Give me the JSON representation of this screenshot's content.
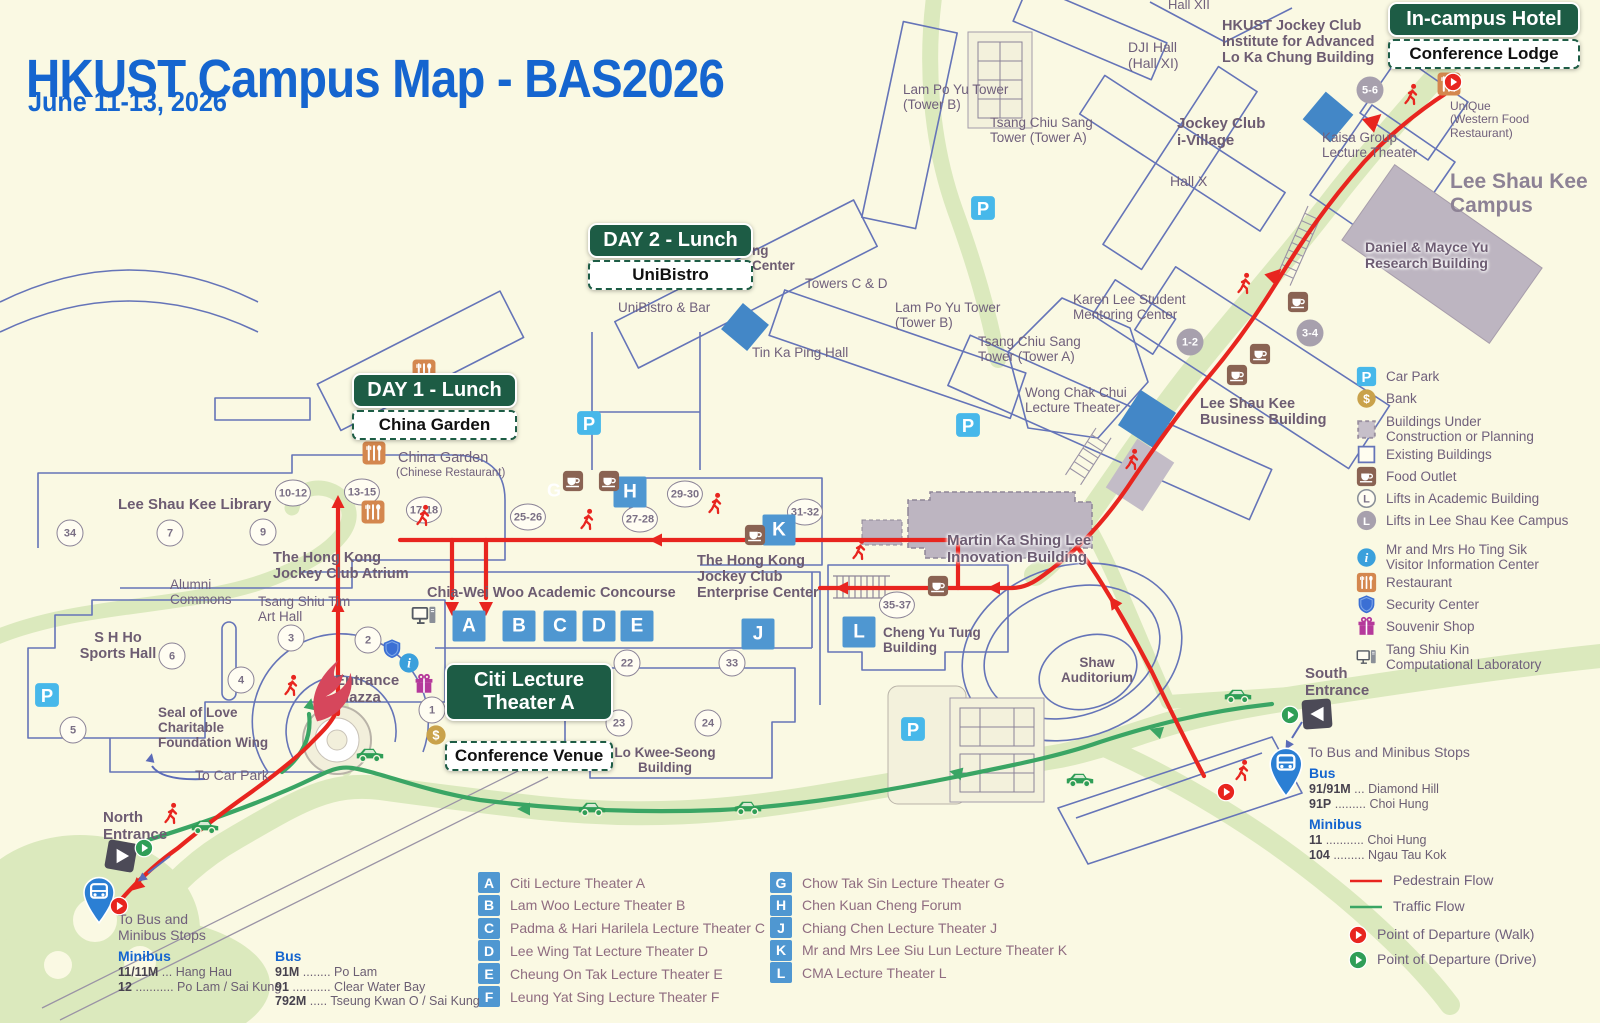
{
  "header": {
    "title": "HKUST Campus Map - BAS2026",
    "subtitle": "June 11-13, 2026"
  },
  "badges": {
    "day1": {
      "title": "DAY 1 - Lunch",
      "subtitle": "China Garden"
    },
    "day2": {
      "title": "DAY 2 - Lunch",
      "subtitle": "UniBistro"
    },
    "venue": {
      "title": "Citi Lecture\nTheater A",
      "subtitle": "Conference Venue"
    },
    "hotel": {
      "title": "In-campus Hotel",
      "subtitle": "Conference Lodge"
    }
  },
  "map_labels": [
    {
      "t": "Hall XII",
      "x": 1168,
      "y": -2,
      "s": 13
    },
    {
      "t": "HKUST Jockey Club\nInstitute for Advanced\nLo Ka Chung Building",
      "x": 1222,
      "y": 18,
      "b": 1,
      "s": 14.5
    },
    {
      "t": "DJI Hall\n(Hall XI)",
      "x": 1128,
      "y": 40,
      "s": 14
    },
    {
      "t": "Lam Po Yu Tower\n(Tower B)",
      "x": 903,
      "y": 82
    },
    {
      "t": "Tsang Chiu Sang\nTower (Tower A)",
      "x": 990,
      "y": 115
    },
    {
      "t": "Jockey Club\ni-Village",
      "x": 1177,
      "y": 116,
      "b": 1,
      "s": 15
    },
    {
      "t": "Hall X",
      "x": 1170,
      "y": 174,
      "s": 14
    },
    {
      "t": "Kaisa Group\nLecture Theater",
      "x": 1322,
      "y": 130
    },
    {
      "t": "UniQue\n(Western Food\nRestaurant)",
      "x": 1450,
      "y": 100,
      "s": 12
    },
    {
      "t": "Lee Shau Kee\nCampus",
      "x": 1450,
      "y": 170,
      "b": 1,
      "s": 21,
      "c": "#8d8295"
    },
    {
      "t": "Daniel & Mayce Yu\nResearch Building",
      "x": 1365,
      "y": 240,
      "b": 1,
      "s": 14,
      "halo": 1
    },
    {
      "t": "Karen Lee Student\nMentoring Center",
      "x": 1073,
      "y": 292
    },
    {
      "t": "ng\nCenter",
      "x": 752,
      "y": 243,
      "b": 1
    },
    {
      "t": "Towers C & D",
      "x": 805,
      "y": 276
    },
    {
      "t": "Lam Po Yu Tower\n(Tower B)",
      "x": 895,
      "y": 300
    },
    {
      "t": "Tsang Chiu Sang\nTower (Tower A)",
      "x": 978,
      "y": 334
    },
    {
      "t": "UniBistro & Bar",
      "x": 618,
      "y": 300
    },
    {
      "t": "Tin Ka Ping Hall",
      "x": 752,
      "y": 345
    },
    {
      "t": "Wong Chak Chui\nLecture Theater",
      "x": 1025,
      "y": 385
    },
    {
      "t": "Lee Shau Kee\nBusiness Building",
      "x": 1200,
      "y": 396,
      "b": 1,
      "s": 14.5
    },
    {
      "t": "China Garden",
      "x": 398,
      "y": 450,
      "s": 14.5
    },
    {
      "t": "(Chinese Restaurant)",
      "x": 396,
      "y": 467,
      "s": 11.5
    },
    {
      "t": "Lee Shau Kee Library",
      "x": 118,
      "y": 497,
      "b": 1,
      "s": 15
    },
    {
      "t": "The Hong Kong\nJockey Club Atrium",
      "x": 273,
      "y": 550,
      "b": 1,
      "s": 14.5
    },
    {
      "t": "Alumni\nCommons",
      "x": 170,
      "y": 577
    },
    {
      "t": "Tsang Shiu Tim\nArt Hall",
      "x": 258,
      "y": 594
    },
    {
      "t": "Chia-Wei Woo Academic Concourse",
      "x": 427,
      "y": 585,
      "b": 1,
      "s": 14.5
    },
    {
      "t": "The Hong Kong\nJockey Club\nEnterprise Center",
      "x": 697,
      "y": 553,
      "b": 1,
      "s": 14.5
    },
    {
      "t": "Martin Ka Shing Lee\nInnovation Building",
      "x": 947,
      "y": 533,
      "b": 1,
      "s": 15,
      "halo": 1
    },
    {
      "t": "S H Ho\nSports Hall",
      "x": 118,
      "y": 630,
      "b": 1,
      "s": 14.5,
      "a": "c"
    },
    {
      "t": "Cheng Yu Tung\nBuilding",
      "x": 883,
      "y": 625,
      "b": 1
    },
    {
      "t": "Shaw\nAuditorium",
      "x": 1097,
      "y": 655,
      "b": 1,
      "a": "c"
    },
    {
      "t": "Seal of Love\nCharitable\nFoundation Wing",
      "x": 158,
      "y": 705,
      "b": 1
    },
    {
      "t": "Entrance\nPiazza",
      "x": 335,
      "y": 673,
      "b": 1,
      "s": 15
    },
    {
      "t": "Lo Kwee-Seong\nBuilding",
      "x": 665,
      "y": 745,
      "b": 1,
      "a": "c"
    },
    {
      "t": "South\nEntrance",
      "x": 1305,
      "y": 666,
      "b": 1,
      "s": 15
    },
    {
      "t": "To Car Park",
      "x": 195,
      "y": 768,
      "s": 14
    },
    {
      "t": "North\nEntrance",
      "x": 103,
      "y": 810,
      "b": 1,
      "s": 15
    },
    {
      "t": "To Bus and\nMinibus Stops",
      "x": 118,
      "y": 912,
      "s": 14
    },
    {
      "t": "To Bus and Minibus Stops",
      "x": 1308,
      "y": 745,
      "s": 14
    }
  ],
  "lifts": [
    {
      "n": "34",
      "x": 70,
      "y": 533
    },
    {
      "n": "7",
      "x": 170,
      "y": 533
    },
    {
      "n": "9",
      "x": 263,
      "y": 532
    },
    {
      "n": "10-12",
      "x": 293,
      "y": 493
    },
    {
      "n": "13-15",
      "x": 362,
      "y": 492
    },
    {
      "n": "17-18",
      "x": 424,
      "y": 510
    },
    {
      "n": "25-26",
      "x": 528,
      "y": 517
    },
    {
      "n": "27-28",
      "x": 640,
      "y": 519
    },
    {
      "n": "29-30",
      "x": 685,
      "y": 494
    },
    {
      "n": "31-32",
      "x": 805,
      "y": 512
    },
    {
      "n": "3",
      "x": 291,
      "y": 638
    },
    {
      "n": "2",
      "x": 368,
      "y": 640
    },
    {
      "n": "6",
      "x": 172,
      "y": 656
    },
    {
      "n": "4",
      "x": 241,
      "y": 680
    },
    {
      "n": "1",
      "x": 432,
      "y": 710
    },
    {
      "n": "5",
      "x": 73,
      "y": 730
    },
    {
      "n": "22",
      "x": 627,
      "y": 663
    },
    {
      "n": "33",
      "x": 732,
      "y": 663
    },
    {
      "n": "23",
      "x": 619,
      "y": 723
    },
    {
      "n": "24",
      "x": 708,
      "y": 723
    },
    {
      "n": "35-37",
      "x": 897,
      "y": 605
    },
    {
      "n": "1-2",
      "x": 1190,
      "y": 342,
      "g": 1
    },
    {
      "n": "3-4",
      "x": 1310,
      "y": 333,
      "g": 1
    },
    {
      "n": "5-6",
      "x": 1370,
      "y": 90,
      "g": 1
    }
  ],
  "theater_squares": [
    {
      "k": "A",
      "x": 469,
      "y": 626
    },
    {
      "k": "B",
      "x": 519,
      "y": 626
    },
    {
      "k": "C",
      "x": 560,
      "y": 626
    },
    {
      "k": "D",
      "x": 599,
      "y": 626
    },
    {
      "k": "E",
      "x": 637,
      "y": 626
    },
    {
      "k": "J",
      "x": 758,
      "y": 634
    },
    {
      "k": "K",
      "x": 779,
      "y": 530
    },
    {
      "k": "H",
      "x": 630,
      "y": 492
    },
    {
      "k": "L",
      "x": 859,
      "y": 632
    },
    {
      "k": "G",
      "x": 554,
      "y": 491,
      "w": 1
    }
  ],
  "map_icons": [
    {
      "t": "car-park",
      "x": 983,
      "y": 208,
      "s": 26
    },
    {
      "t": "car-park",
      "x": 589,
      "y": 423,
      "s": 26
    },
    {
      "t": "car-park",
      "x": 968,
      "y": 425,
      "s": 26
    },
    {
      "t": "car-park",
      "x": 47,
      "y": 695,
      "s": 26
    },
    {
      "t": "car-park",
      "x": 913,
      "y": 729,
      "s": 26
    },
    {
      "t": "food-outlet",
      "x": 573,
      "y": 481
    },
    {
      "t": "food-outlet",
      "x": 609,
      "y": 481
    },
    {
      "t": "food-outlet",
      "x": 755,
      "y": 535
    },
    {
      "t": "food-outlet",
      "x": 938,
      "y": 586
    },
    {
      "t": "food-outlet",
      "x": 1237,
      "y": 375
    },
    {
      "t": "food-outlet",
      "x": 1298,
      "y": 302
    },
    {
      "t": "food-outlet",
      "x": 1260,
      "y": 354
    },
    {
      "t": "restaurant",
      "x": 374,
      "y": 453,
      "s": 25
    },
    {
      "t": "restaurant",
      "x": 373,
      "y": 512,
      "s": 25
    },
    {
      "t": "restaurant",
      "x": 424,
      "y": 371,
      "s": 25
    },
    {
      "t": "restaurant",
      "x": 1449,
      "y": 84,
      "s": 25
    },
    {
      "t": "visitor-info",
      "x": 409,
      "y": 663
    },
    {
      "t": "security",
      "x": 392,
      "y": 649
    },
    {
      "t": "souvenir",
      "x": 424,
      "y": 684
    },
    {
      "t": "bank",
      "x": 436,
      "y": 735
    },
    {
      "t": "computer",
      "x": 424,
      "y": 616,
      "s": 26
    },
    {
      "t": "bus-pin",
      "x": 99,
      "y": 900,
      "s": 38
    },
    {
      "t": "bus-pin",
      "x": 1286,
      "y": 772,
      "s": 40
    },
    {
      "t": "entrance-n",
      "x": 121,
      "y": 856,
      "s": 38
    },
    {
      "t": "entrance-s",
      "x": 1317,
      "y": 714,
      "s": 38
    },
    {
      "t": "dep-walk",
      "x": 119,
      "y": 906,
      "s": 20
    },
    {
      "t": "dep-walk",
      "x": 1453,
      "y": 82,
      "s": 20
    },
    {
      "t": "dep-walk",
      "x": 1226,
      "y": 792,
      "s": 20
    },
    {
      "t": "dep-drive",
      "x": 144,
      "y": 848,
      "s": 20
    },
    {
      "t": "dep-drive",
      "x": 1290,
      "y": 715,
      "s": 20
    },
    {
      "t": "flame",
      "x": 330,
      "y": 690,
      "s": 48
    },
    {
      "t": "walker",
      "x": 424,
      "y": 516,
      "s": 24
    },
    {
      "t": "walker",
      "x": 588,
      "y": 520,
      "s": 24
    },
    {
      "t": "walker",
      "x": 716,
      "y": 504,
      "s": 24
    },
    {
      "t": "walker",
      "x": 860,
      "y": 550,
      "s": 24
    },
    {
      "t": "walker",
      "x": 1133,
      "y": 460,
      "s": 24
    },
    {
      "t": "walker",
      "x": 1245,
      "y": 284,
      "s": 24
    },
    {
      "t": "walker",
      "x": 1412,
      "y": 95,
      "s": 24
    },
    {
      "t": "walker",
      "x": 1243,
      "y": 771,
      "s": 24
    },
    {
      "t": "walker",
      "x": 172,
      "y": 814,
      "s": 24
    },
    {
      "t": "walker",
      "x": 292,
      "y": 686,
      "s": 24
    },
    {
      "t": "car",
      "x": 205,
      "y": 824,
      "s": 30
    },
    {
      "t": "car",
      "x": 370,
      "y": 752,
      "s": 30
    },
    {
      "t": "car",
      "x": 592,
      "y": 806,
      "s": 30
    },
    {
      "t": "car",
      "x": 748,
      "y": 805,
      "s": 30
    },
    {
      "t": "car",
      "x": 1080,
      "y": 777,
      "s": 30
    },
    {
      "t": "car",
      "x": 1238,
      "y": 693,
      "s": 30
    },
    {
      "t": "tennis-court",
      "x": 1000,
      "y": 80,
      "s": 0
    },
    {
      "t": "tennis-court",
      "x": 997,
      "y": 750,
      "s": 0
    }
  ],
  "legend": {
    "x_icon": 1356,
    "x_label": 1390,
    "items": [
      {
        "icon": "car-park",
        "label": "Car Park",
        "y": 377
      },
      {
        "icon": "bank",
        "label": "Bank",
        "y": 399
      },
      {
        "icon": "construction",
        "label": "Buildings Under\nConstruction or Planning",
        "y": 425
      },
      {
        "icon": "existing",
        "label": "Existing Buildings",
        "y": 455
      },
      {
        "icon": "food-outlet",
        "label": "Food Outlet",
        "y": 477
      },
      {
        "icon": "lift-academic",
        "label": "Lifts in Academic Building",
        "y": 499
      },
      {
        "icon": "lift-lsk",
        "label": "Lifts in Lee Shau Kee Campus",
        "y": 521
      },
      {
        "icon": "visitor-info",
        "label": "Mr and Mrs Ho Ting Sik\nVisitor Information Center",
        "y": 553
      },
      {
        "icon": "restaurant",
        "label": "Restaurant",
        "y": 583
      },
      {
        "icon": "security",
        "label": "Security Center",
        "y": 605
      },
      {
        "icon": "souvenir",
        "label": "Souvenir Shop",
        "y": 627
      },
      {
        "icon": "computer",
        "label": "Tang Shiu Kin\nComputational Laboratory",
        "y": 653
      }
    ]
  },
  "flow_legend": {
    "x_icon": 1348,
    "x_label": 1393,
    "items": [
      {
        "icon": "ped-flow",
        "label": "Pedestrain Flow",
        "y": 884
      },
      {
        "icon": "traffic-flow",
        "label": "Traffic Flow",
        "y": 910
      },
      {
        "icon": "dep-walk",
        "label": "Point of Departure (Walk)",
        "y": 936
      },
      {
        "icon": "dep-drive",
        "label": "Point of Departure (Drive)",
        "y": 961
      }
    ]
  },
  "theater_legend": {
    "left": {
      "sq_x": 478,
      "label_x": 505,
      "start_y": 882,
      "step": 22.8,
      "items": [
        {
          "k": "A",
          "label": "Citi Lecture Theater A"
        },
        {
          "k": "B",
          "label": "Lam Woo Lecture Theater B"
        },
        {
          "k": "C",
          "label": "Padma & Hari Harilela Lecture Theater C"
        },
        {
          "k": "D",
          "label": "Lee Wing Tat Lecture Theater D"
        },
        {
          "k": "E",
          "label": "Cheung On Tak Lecture Theater E"
        },
        {
          "k": "F",
          "label": "Leung Yat Sing Lecture Theater F"
        }
      ]
    },
    "right": {
      "sq_x": 770,
      "label_x": 797,
      "start_y": 882,
      "step": 22.6,
      "items": [
        {
          "k": "G",
          "label": "Chow Tak Sin Lecture Theater G"
        },
        {
          "k": "H",
          "label": "Chen Kuan Cheng Forum"
        },
        {
          "k": "J",
          "label": "Chiang Chen Lecture Theater J"
        },
        {
          "k": "K",
          "label": "Mr and Mrs Lee Siu Lun Lecture Theater K"
        },
        {
          "k": "L",
          "label": "CMA Lecture Theater L"
        }
      ]
    }
  },
  "bus_north": {
    "groups": [
      {
        "heading": "Minibus",
        "x": 118,
        "y": 948,
        "rows": [
          {
            "n": "11/11M",
            "r": " ... Hang Hau"
          },
          {
            "n": "12",
            "r": " ........... Po Lam / Sai Kung"
          }
        ]
      },
      {
        "heading": "Bus",
        "x": 275,
        "y": 948,
        "rows": [
          {
            "n": "91M",
            "r": " ........ Po Lam"
          },
          {
            "n": "91",
            "r": " ........... Clear Water Bay"
          },
          {
            "n": "792M",
            "r": " ..... Tseung Kwan O / Sai Kung"
          }
        ]
      }
    ]
  },
  "bus_south": {
    "groups": [
      {
        "heading": "Bus",
        "x": 1309,
        "y": 765,
        "rows": [
          {
            "n": "91/91M",
            "r": " ... Diamond Hill"
          },
          {
            "n": "91P",
            "r": " ......... Choi Hung"
          }
        ]
      },
      {
        "heading": "Minibus",
        "x": 1309,
        "y": 816,
        "rows": [
          {
            "n": "11",
            "r": " ........... Choi Hung"
          },
          {
            "n": "104",
            "r": " ......... Ngau Tau Kok"
          }
        ]
      }
    ]
  },
  "colors": {
    "accent_blue": "#1565cf",
    "badge_green": "#1d5c45",
    "ped_flow": "#e8251f",
    "traffic_flow": "#3aa564",
    "theater_blue": "#4f97d1",
    "car_park_blue": "#47b8ea"
  }
}
